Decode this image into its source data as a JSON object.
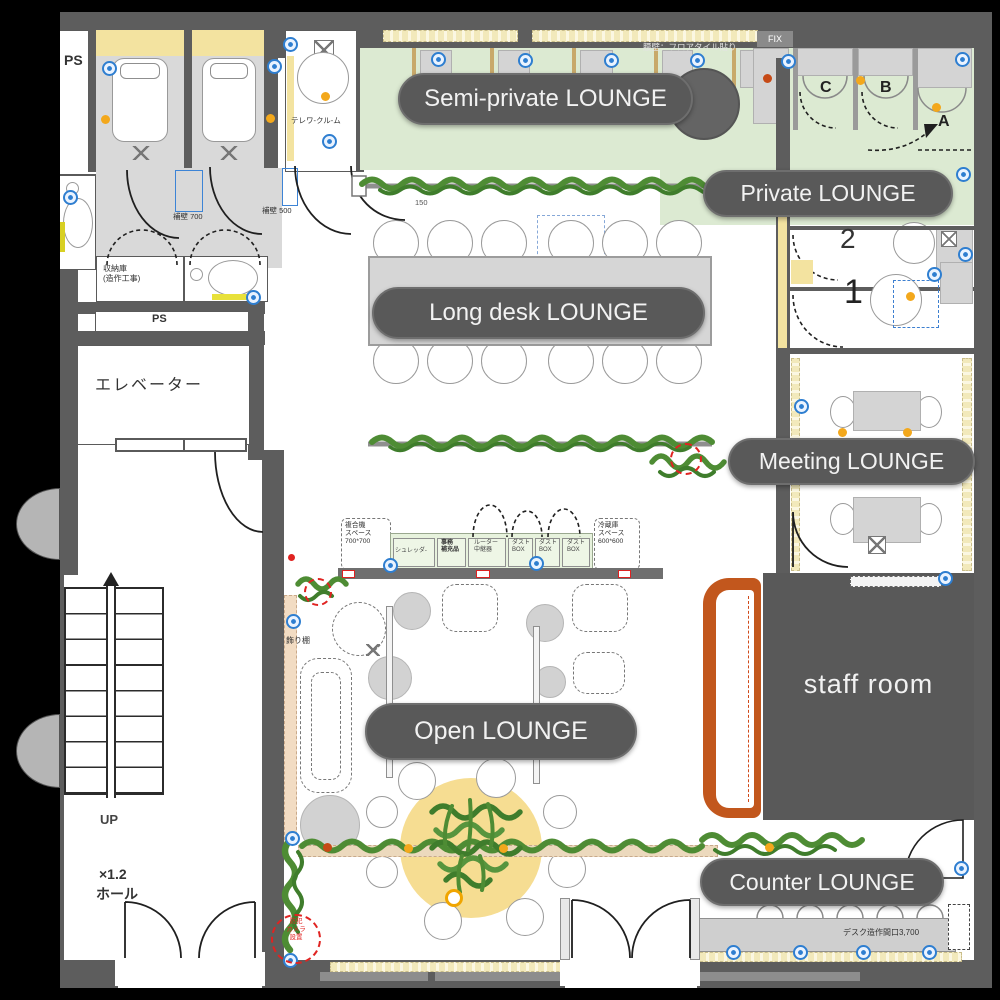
{
  "pills": {
    "semi_private": "Semi-private LOUNGE",
    "private": "Private LOUNGE",
    "long_desk": "Long desk LOUNGE",
    "meeting": "Meeting LOUNGE",
    "open": "Open LOUNGE",
    "counter": "Counter LOUNGE"
  },
  "staff_room": "staff room",
  "rooms": {
    "telework": "テレワ-クル-ム",
    "elevator": "エレベーター",
    "up": "UP",
    "hall_scale": "×1.2",
    "hall": "ホール",
    "ps_top": "PS",
    "ps_mid": "PS",
    "storage": "収納庫\n(造作工事)",
    "display_shelf": "飾り棚"
  },
  "booths": {
    "a": "A",
    "b": "B",
    "c": "C",
    "room1": "1",
    "room2": "2"
  },
  "annotations": {
    "waist_wall": "腰壁：フロアタイル貼り",
    "fix": "FIX",
    "wall700": "補壁 700",
    "wall500": "補壁 500",
    "ac": "AC",
    "dim150": "150",
    "desk_width": "デスク造作間口3,700",
    "camera": "防犯\nカメラ\n設置",
    "mfp": "複合機\nスペース\n700*700",
    "fridge": "冷蔵庫\nスペース\n600*600",
    "shredder": "シュレッダ-",
    "office_supplies": "事務\n補充品",
    "router": "ルーター\n中継器",
    "dust_box": "ダスト\nBOX"
  },
  "colors": {
    "wall": "#5d5d5d",
    "floor_green": "#dcead2",
    "accent_yellow": "#f3e3a0",
    "counter_orange": "#c2571d",
    "rug_yellow": "#f6dd92",
    "plant_green": "#4e8c34",
    "symbol_blue": "#2e7ed0",
    "downlight": "#f3a81c",
    "pill_bg": "#595959",
    "stamp_red": "#e02321"
  }
}
